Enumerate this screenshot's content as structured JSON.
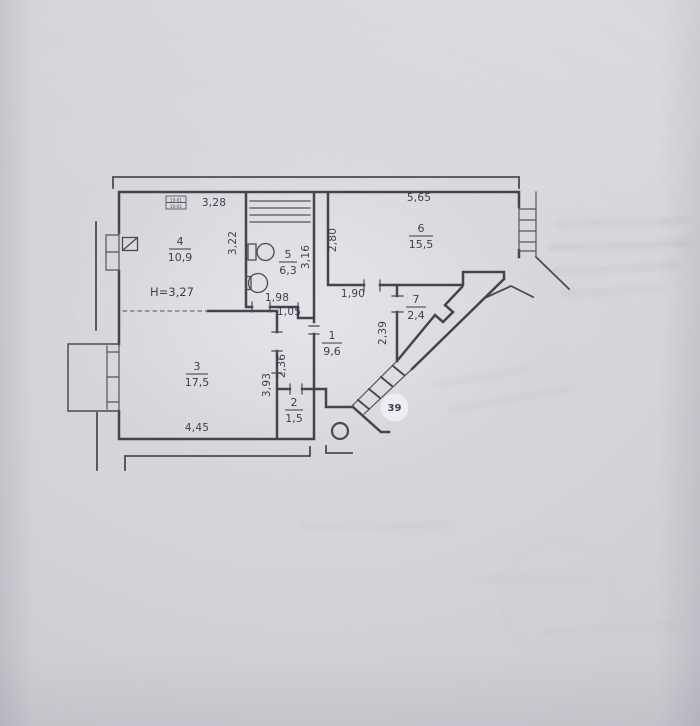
{
  "plan": {
    "apartment_number": "39",
    "ceiling_height": "H=3,27",
    "stamp": {
      "line1": "10-01",
      "line2": "10-01"
    },
    "rooms": [
      {
        "id": "1",
        "area": "9,6"
      },
      {
        "id": "2",
        "area": "1,5"
      },
      {
        "id": "3",
        "area": "17,5"
      },
      {
        "id": "4",
        "area": "10,9"
      },
      {
        "id": "5",
        "area": "6,3"
      },
      {
        "id": "6",
        "area": "15,5"
      },
      {
        "id": "7",
        "area": "2,4"
      }
    ],
    "dims": {
      "room4_top": "3,28",
      "room4_right": "3,22",
      "room6_top": "5,65",
      "room6_left": "2,80",
      "room5_right": "3,16",
      "bath_wall": "1,98",
      "bath_stub": "1,05",
      "room6_door_wall": "1,90",
      "room7_left": "2,39",
      "hall_left": "2,36",
      "room3_right": "3,93",
      "room3_bottom": "4,45"
    }
  }
}
